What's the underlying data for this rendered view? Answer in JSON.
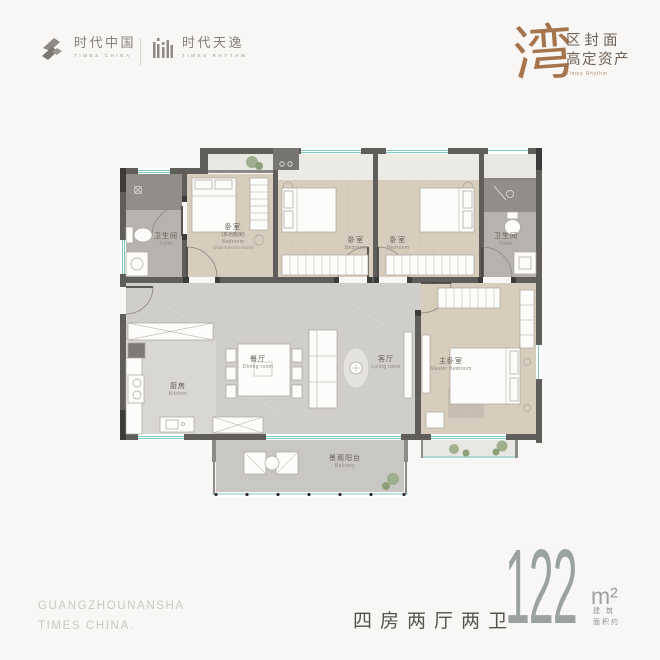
{
  "header": {
    "brand_primary": {
      "cn": "时代中国",
      "en": "TIMES CHINA"
    },
    "brand_secondary": {
      "cn": "时代天逸",
      "en": "TIMES RHYTHM"
    },
    "tagline": {
      "calligraphy": "湾",
      "line1": "区封面",
      "line2": "高定资产",
      "sub": "Times Rhythm"
    }
  },
  "floorplan": {
    "rooms": {
      "toilet_left": {
        "cn": "卫生间",
        "en": "Toilet"
      },
      "bedroom_multi": {
        "cn": "卧室",
        "sub": "(多功能房)",
        "en": "Bedroom",
        "sub_en": "(Multi-function room)"
      },
      "bedroom_2": {
        "cn": "卧室",
        "en": "Bedroom"
      },
      "bedroom_3": {
        "cn": "卧室",
        "en": "Bedroom"
      },
      "toilet_right": {
        "cn": "卫生间",
        "en": "Toilet"
      },
      "dining": {
        "cn": "餐厅",
        "en": "Dining room"
      },
      "living": {
        "cn": "客厅",
        "en": "Living room"
      },
      "master": {
        "cn": "主卧室",
        "en": "Master Bedroom"
      },
      "kitchen": {
        "cn": "厨房",
        "en": "Kitchen"
      },
      "balcony": {
        "cn": "景观阳台",
        "en": "Balcony"
      }
    }
  },
  "footer": {
    "location_line1": "GUANGZHOUNANSHA",
    "location_line2": "TIMES CHINA.",
    "layout": "四房两厅两卫",
    "area_value": "122",
    "area_unit": "m²",
    "area_note_line1": "建 筑",
    "area_note_line2": "面积约"
  },
  "colors": {
    "background": "#f8f7f5",
    "wall": "#5f5e5b",
    "window_teal": "#7fc8bf",
    "wood_floor": "#d8cdbd",
    "tile_floor": "#cecdc9",
    "bath_floor": "#b6b3af",
    "accent_brown": "#a6744c",
    "area_text": "#9ba19f"
  }
}
